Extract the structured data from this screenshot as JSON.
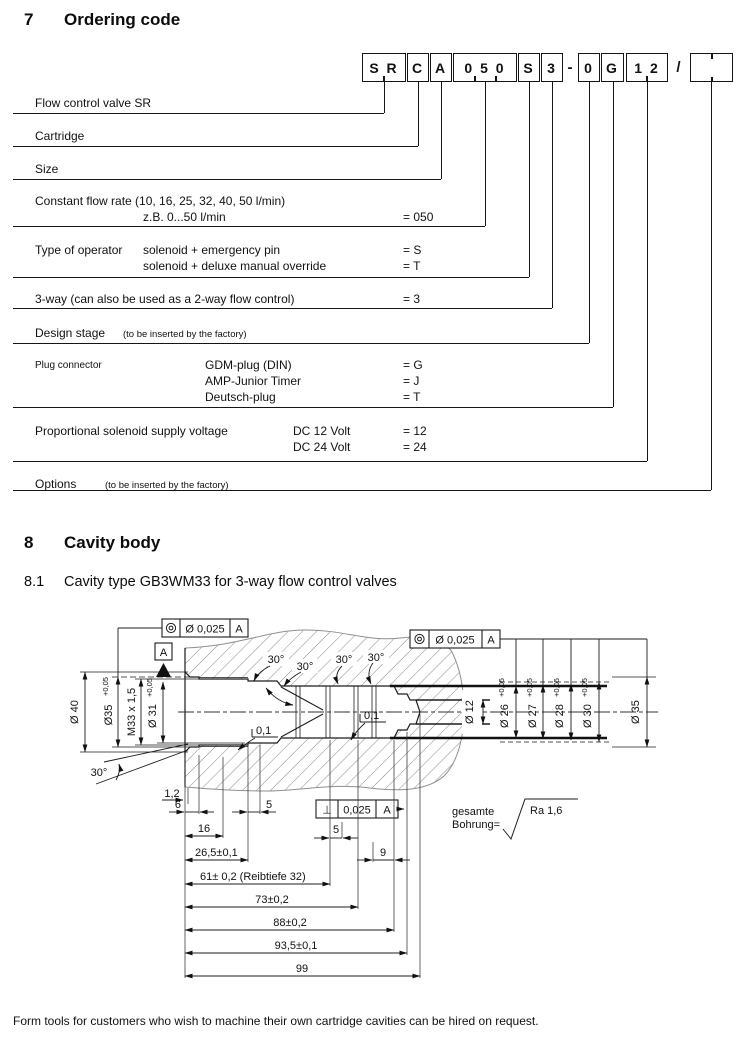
{
  "section7": {
    "num": "7",
    "title": "Ordering code"
  },
  "code": {
    "boxes": [
      "S R",
      "C",
      "A",
      "0 5 0",
      "S",
      "3",
      "0",
      "G",
      "1 2",
      ""
    ],
    "dash": "-",
    "slash": "/",
    "rows": [
      {
        "label": "Flow control valve SR"
      },
      {
        "label": "Cartridge"
      },
      {
        "label": "Size"
      },
      {
        "label": "Constant flow rate (10, 16, 25, 32, 40, 50 l/min)",
        "line2": "z.B. 0...50 l/min",
        "val1": "= 050"
      },
      {
        "label": "Type of operator",
        "opt1": "solenoid + emergency pin",
        "val1": "= S",
        "opt2": "solenoid + deluxe manual override",
        "val2": "= T"
      },
      {
        "label": "3-way (can also be used as a 2-way flow control)",
        "val1": "= 3"
      },
      {
        "label": "Design stage",
        "note": "(to be inserted by the factory)"
      },
      {
        "label": "Plug connector",
        "opt1": "GDM-plug (DIN)",
        "val1": "= G",
        "opt2": "AMP-Junior Timer",
        "val2": "= J",
        "opt3": "Deutsch-plug",
        "val3": "= T"
      },
      {
        "label": "Proportional solenoid supply voltage",
        "opt1": "DC 12 Volt",
        "val1": "= 12",
        "opt2": "DC 24 Volt",
        "val2": "= 24"
      },
      {
        "label": "Options",
        "note": "(to be inserted by the factory)"
      }
    ]
  },
  "section8": {
    "num": "8",
    "title": "Cavity body"
  },
  "section8_1": {
    "num": "8.1",
    "title": "Cavity type GB3WM33 for 3-way flow control valves"
  },
  "drawing": {
    "fcf_left": {
      "symbol": "concentricity",
      "tolerance": "Ø 0,025",
      "datum": "A"
    },
    "fcf_right": {
      "symbol": "concentricity",
      "tolerance": "Ø 0,025",
      "datum": "A"
    },
    "fcf_perp": {
      "symbol": "⊥",
      "tolerance": "0,025",
      "datum": "A"
    },
    "datum": "A",
    "dims_left": [
      {
        "text": "Ø 40",
        "sup": ""
      },
      {
        "text": "Ø35",
        "sup": "+0,05"
      },
      {
        "text": "M33 x 1,5",
        "sup": ""
      },
      {
        "text": "Ø 31",
        "sup": "+0,05"
      }
    ],
    "dims_right": [
      {
        "text": "Ø 12",
        "sup": ""
      },
      {
        "text": "Ø 26",
        "sup": "+0,05"
      },
      {
        "text": "Ø 27",
        "sup": "+0,05"
      },
      {
        "text": "Ø 28",
        "sup": "+0,05"
      },
      {
        "text": "Ø 30",
        "sup": "+0,05"
      },
      {
        "text": "Ø 35",
        "sup": ""
      }
    ],
    "angle_chamfer": "30°",
    "step_dim_left": "0,1",
    "step_dim_right": "0,1",
    "dims_bottom": {
      "d12": "1,2",
      "d6": "6",
      "d5a": "5",
      "d16": "16",
      "d5b": "5",
      "d26": "26,5±0,1",
      "d9": "9",
      "d61": "61± 0,2 (Reibtiefe 32)",
      "d73": "73±0,2",
      "d88": "88±0,2",
      "d935": "93,5±0,1",
      "d99": "99"
    },
    "note": {
      "l1": "gesamte",
      "l2": "Bohrung=",
      "ra": "Ra 1,6"
    }
  },
  "footer": {
    "text": "Form tools for customers who wish to machine their own cartridge cavities can be hired on request."
  }
}
